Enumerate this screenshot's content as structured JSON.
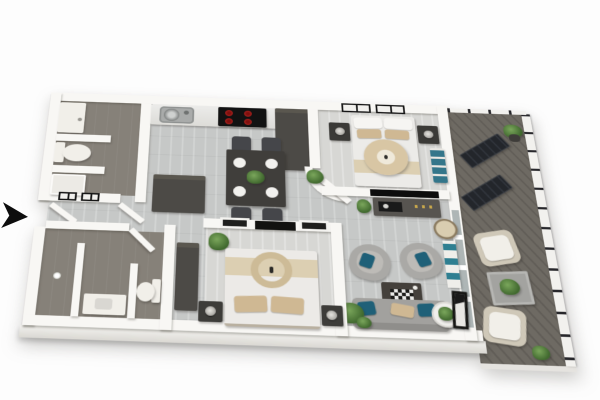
{
  "image_type": "3d-rendered-apartment-floor-plan",
  "visible_text": [],
  "entry_arrow": {
    "direction": "right",
    "color": "#0d0d0d"
  },
  "colors": {
    "wall": "#f8f7f4",
    "wood": "#c6c8c7",
    "wood_light": "#d7d7d4",
    "bath": "#868179",
    "deck": "#6e6a63",
    "dark": "#403e3b",
    "charcoal": "#4c4a46",
    "charcoal_top": "#5a574f",
    "teal": "#1f6078",
    "teal_decor": "#2f7f91",
    "tan": "#cfb893",
    "tan_light": "#dccfb2",
    "green": "#41692f",
    "sofa": "#a2a19e",
    "white_f": "#f1efe9",
    "red": "#d9312c",
    "black": "#121212",
    "glass": "#aeb6b6",
    "slab": "#eceae6",
    "arrow": "#0d0d0d"
  },
  "rooms": [
    {
      "name": "bathroom-1",
      "position": "top-left",
      "floor": "dark-tile",
      "furniture": [
        "vanity-sink",
        "half-wall",
        "toilet",
        "shower"
      ]
    },
    {
      "name": "kitchen",
      "position": "top-center",
      "furniture": [
        "counter",
        "stainless-sink",
        "cooktop-4-red-burners",
        "tall-cabinet"
      ]
    },
    {
      "name": "dining-area",
      "position": "center-left",
      "furniture": [
        "dark-table",
        "4-chairs",
        "4-place-settings",
        "centerpiece-plant"
      ]
    },
    {
      "name": "bedroom-1",
      "position": "top-right",
      "furniture": [
        "double-bed",
        "2-tan-pillows",
        "round-ottoman",
        "2-nightstands-with-lamps",
        "wardrobe",
        "2-black-framed-windows",
        "teal-accent-chair",
        "plant",
        "curved-wall",
        "open-door"
      ]
    },
    {
      "name": "living-room",
      "position": "bottom-right",
      "furniture": [
        "tv-on-wall",
        "media-console",
        "round-rattan-chair",
        "2-gray-armchairs-teal-pillows",
        "checkerboard-coffee-table",
        "gray-sofa-with-pillows",
        "round-side-table-plant",
        "shelf-with-teal-books",
        "leaning-mirror",
        "plants"
      ]
    },
    {
      "name": "bedroom-2",
      "position": "bottom-center",
      "furniture": [
        "double-bed",
        "round-decor-ring",
        "2-tan-pillows",
        "2-nightstands-with-lamps",
        "wardrobe",
        "wall-console",
        "2-interior-windows",
        "plant",
        "open-door"
      ]
    },
    {
      "name": "bathroom-2",
      "position": "bottom-left",
      "furniture": [
        "partition-walls",
        "vanity",
        "toilet",
        "flower-decor",
        "open-door"
      ]
    },
    {
      "name": "hallway",
      "position": "center",
      "furniture": [
        "entry-door",
        "closet-block",
        "window-symbols"
      ]
    },
    {
      "name": "balcony",
      "position": "right",
      "floor": "dark-decking",
      "furniture": [
        "railing-with-posts",
        "2-dark-sun-loungers",
        "potted-plant",
        "2-white-armchairs",
        "square-outdoor-table",
        "small-plants"
      ]
    }
  ]
}
